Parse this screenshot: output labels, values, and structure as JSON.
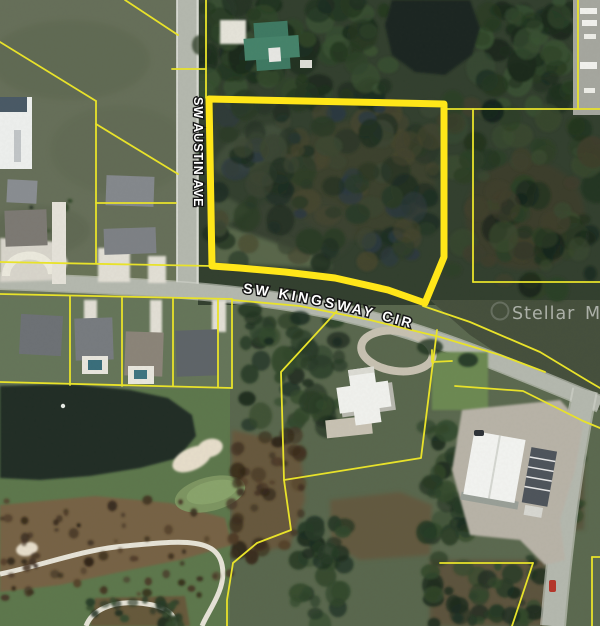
{
  "map": {
    "streets": {
      "vertical": "SW AUSTIN AVE",
      "curved": "SW KINGSWAY CIR"
    },
    "watermark": {
      "part1": "Stellar",
      "part2": "MLS"
    },
    "highlight": {
      "points": "209,99 444,104 444,257 425,303 388,290 335,278 285,272 240,268 212,266",
      "color": "#ffe619",
      "stroke_width": "7"
    },
    "parcel_lines": {
      "color": "#e8e22a",
      "width": "1.8",
      "lines": [
        "206,0 206,98",
        "172,69 206,69",
        "125,0 178,35",
        "0,42 96,101",
        "96,101 96,263",
        "96,124 178,174",
        "96,203 176,203",
        "0,262 212,266",
        "0,294 232,299",
        "70,296 70,385",
        "122,298 122,386",
        "173,299 173,386",
        "218,300 218,387",
        "232,299 232,388",
        "0,382 232,388",
        "337,311 281,372 284,480 291,530 257,543 233,563 227,600 227,626",
        "437,330 421,458 284,480",
        "232,300 300,306 370,320 440,337 500,355 545,372",
        "423,306 470,322 540,352 588,381 600,388",
        "447,109 600,109",
        "473,109 473,282",
        "473,282 600,282",
        "578,0 578,109",
        "455,386 523,391 583,421 600,428",
        "440,563 533,563",
        "533,563 512,626",
        "592,557 600,557",
        "592,557 592,626",
        "432,350 432,362 452,361"
      ]
    },
    "colors": {
      "highlight_yellow": "#ffe619",
      "parcel_yellow": "#e8e22a",
      "road_gray": "#b5b9af",
      "water_dark": "#1d2721",
      "grass_green": "#5f7750",
      "canopy_green": "#2c3e2b",
      "sand_tan": "#e7decb",
      "label_white": "#ffffff"
    }
  }
}
